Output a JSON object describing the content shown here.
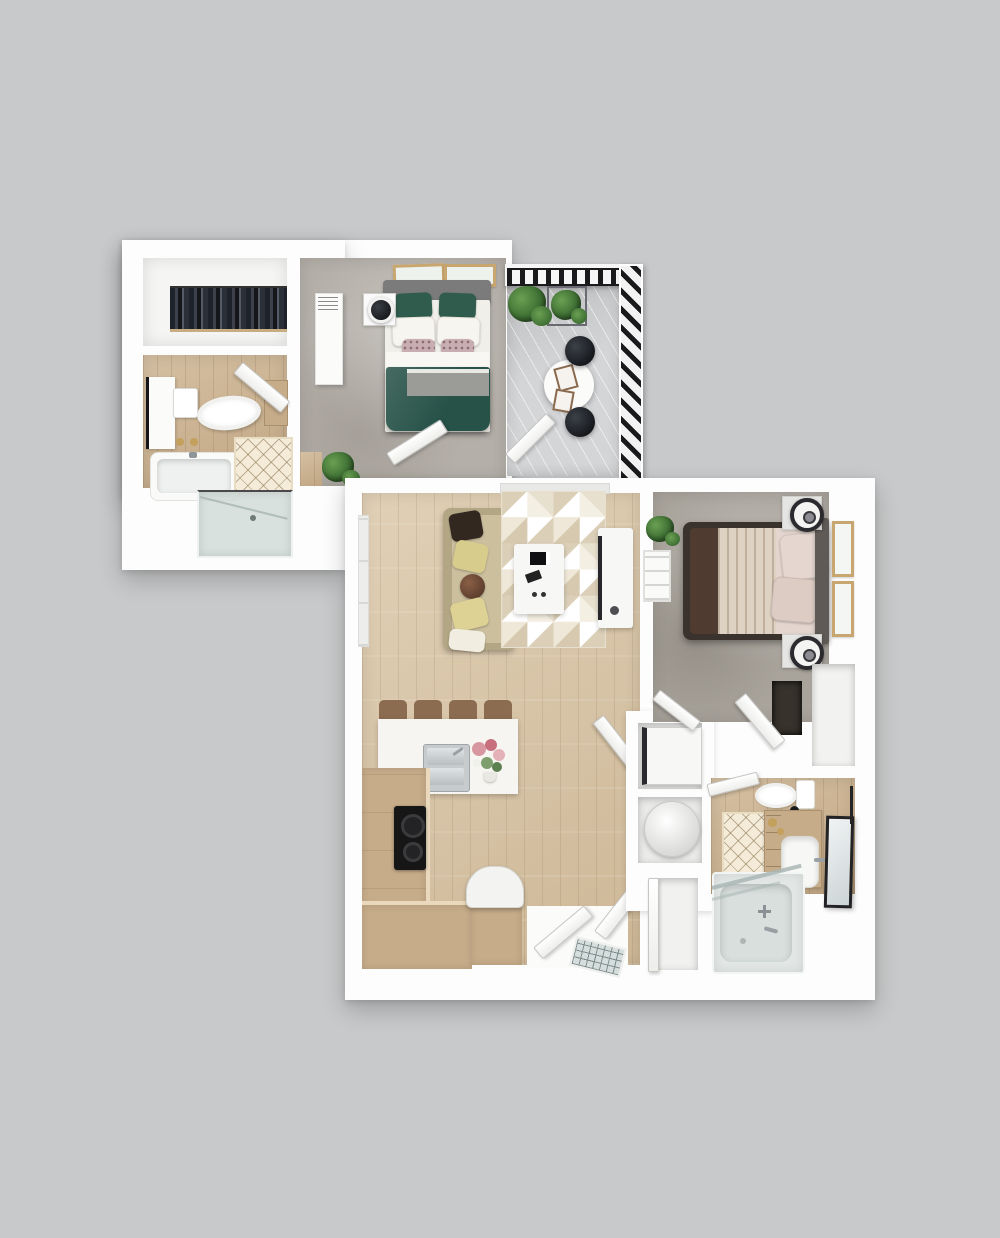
{
  "scene": {
    "label": "3D rendered top-down apartment floor plan with bedroom suite, balcony, open living-kitchen area, second bedroom and two bathrooms",
    "background": "#c8c9ca"
  },
  "colors": {
    "bg": "#c8c9ca",
    "wall": "#fdfdfd",
    "wallsoft": "#f4f4f2",
    "wood": "#d8c3a2",
    "woodd": "#ccb28e",
    "carpet": "#b4afa8",
    "carpetd": "#a8a39b",
    "deck": "#d4d5d7",
    "rail": "#1a1a1c",
    "bedgreen": "#275248",
    "pillowgreen": "#2f5c4d",
    "headboard": "#7b7b7b",
    "headboardd": "#5f5a55",
    "sofa": "#b2a684",
    "sofaseat": "#cbbf9e",
    "counter": "#c6ac89",
    "countertop": "#ead9bd",
    "islandw": "#f6f5f1",
    "cooktop": "#161617",
    "stool": "#8c6c50",
    "bedframe": "#3a322c",
    "bedbrown": "#4f3b30",
    "blanket": "#ded3c2",
    "pillowpink": "#e5d7d0",
    "framegold": "#c7a76f",
    "plantd": "#3f7034",
    "plantl": "#6aa052",
    "glassb": "#cdd8d6",
    "tubw": "#e2e7e5",
    "steel": "#c7cbcd",
    "gold": "#c3a05c",
    "dark": "#23262b"
  },
  "units": [
    {
      "id": "upper-unit",
      "rooms": [
        {
          "name": "walk-in-closet",
          "items": [
            "clothes-rack"
          ]
        },
        {
          "name": "bathroom",
          "items": [
            "tall-cabinet",
            "towel-hooks",
            "toilet",
            "wood-cabinet",
            "bathtub",
            "diamond-rug",
            "door",
            "glass-shower"
          ]
        },
        {
          "name": "bedroom",
          "items": [
            "wall-art",
            "wall-art",
            "headboard",
            "double-bed-green-duvet",
            "green-accent-pillows",
            "white-pillows",
            "floral-pillows",
            "gray-throw",
            "nightstand",
            "table-lamp",
            "wardrobe",
            "potted-plant",
            "door"
          ]
        },
        {
          "name": "balcony",
          "items": [
            "top-railing",
            "side-railing",
            "plank-deck",
            "planter-box",
            "plant",
            "plant",
            "round-cafe-table",
            "serving-trays",
            "stool",
            "stool",
            "door"
          ]
        }
      ]
    },
    {
      "id": "main-unit",
      "rooms": [
        {
          "name": "living-room",
          "items": [
            "window-wall",
            "balcony-door-track",
            "sofa",
            "throw-pillows",
            "geometric-area-rug",
            "coffee-table",
            "remotes",
            "tv-console",
            "tv"
          ]
        },
        {
          "name": "kitchen",
          "items": [
            "bar-stools",
            "island",
            "double-sink",
            "faucet",
            "flower-bouquet",
            "vase",
            "l-shaped-counter",
            "cooktop",
            "refrigerator"
          ]
        },
        {
          "name": "entry",
          "items": [
            "vestibule",
            "double-doors",
            "doormat",
            "coat-closet"
          ]
        },
        {
          "name": "laundry",
          "items": [
            "washer",
            "water-heater"
          ]
        },
        {
          "name": "bedroom",
          "items": [
            "double-bed",
            "brown-duvet",
            "pleated-blanket",
            "pillows",
            "headboard",
            "nightstand-with-lamp",
            "nightstand-with-lamp",
            "wall-art",
            "wall-art",
            "plant",
            "ladder-shelf",
            "closet-niche",
            "door",
            "alcove"
          ]
        },
        {
          "name": "bathroom",
          "items": [
            "toilet",
            "paper-holder",
            "diamond-rug",
            "vanity",
            "sink",
            "faucet",
            "soap-dishes",
            "leaning-mirror",
            "towel-bar",
            "bathtub",
            "glass-screen",
            "door"
          ]
        }
      ]
    }
  ]
}
